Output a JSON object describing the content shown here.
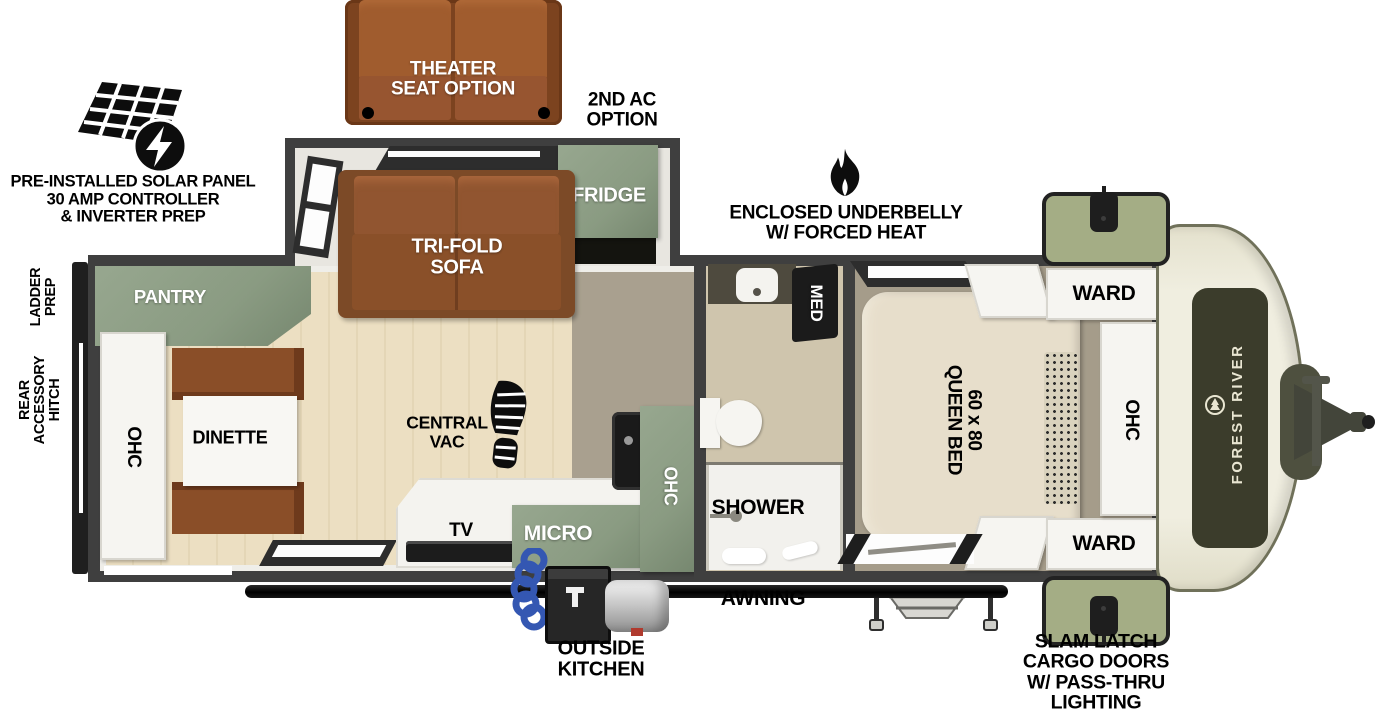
{
  "callouts": {
    "solar": {
      "text": "PRE-INSTALLED SOLAR PANEL\n30 AMP CONTROLLER\n& INVERTER PREP"
    },
    "theater_seat": {
      "text": "THEATER\nSEAT OPTION"
    },
    "second_ac": {
      "text": "2ND AC\nOPTION"
    },
    "underbelly": {
      "text": "ENCLOSED UNDERBELLY\nW/ FORCED HEAT"
    },
    "ladder_prep": {
      "text": "LADDER\nPREP"
    },
    "rear_hitch": {
      "text": "REAR\nACCESSORY\nHITCH"
    },
    "awning": {
      "text": "AWNING"
    },
    "outside_kitchen": {
      "text": "OUTSIDE\nKITCHEN"
    },
    "slam_latch": {
      "text": "SLAM LATCH\nCARGO DOORS\nW/ PASS-THRU\nLIGHTING"
    }
  },
  "rooms": {
    "pantry": "PANTRY",
    "ohc_rear": "OHC",
    "dinette": "DINETTE",
    "central_vac": "CENTRAL\nVAC",
    "tv": "TV",
    "micro": "MICRO",
    "ohc_kitchen": "OHC",
    "fridge": "FRIDGE",
    "sofa": "TRI-FOLD\nSOFA",
    "med": "MED",
    "shower": "SHOWER",
    "queen_bed": "60 x 80\nQUEEN BED",
    "ward_top": "WARD",
    "ward_bottom": "WARD",
    "ohc_bedroom": "OHC"
  },
  "brand": {
    "name": "FOREST RIVER"
  },
  "colors": {
    "wall_gray": "#3f3f3f",
    "cabinet_green": "#8a9b82",
    "cargo_door_green": "#a4ad85",
    "sofa_brown": "#8a5029",
    "bench_brown": "#8a4e28",
    "wood_floor": "#ebdfc2",
    "galley_floor": "#a9a08f",
    "bed_beige": "#e7decb",
    "front_cap_cream": "#eceadb",
    "decal_olive": "#3b3c2b",
    "hitch_olive": "#4e503f",
    "hose_blue": "#3457b2",
    "label_black": "#000000",
    "label_white": "#ffffff"
  }
}
